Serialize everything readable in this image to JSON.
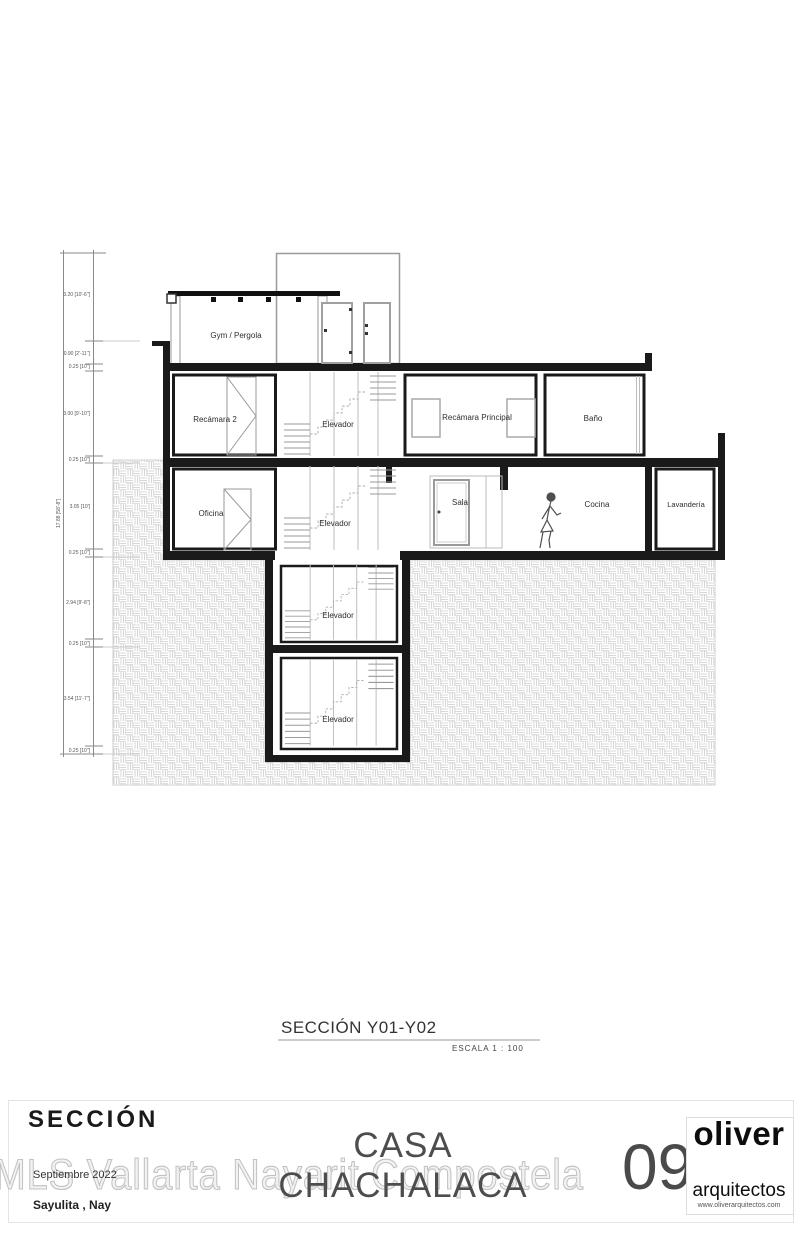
{
  "sheet": {
    "section_label": "SECCIÓN Y01-Y02",
    "scale_label": "ESCALA 1 : 100",
    "sheet_type": "SECCIÓN",
    "project_title": "CASA CHACHALACA",
    "watermark": "MLS Vallarta Nayarit Compostela",
    "date": "Septiembre 2022",
    "location": "Sayulita , Nay",
    "sheet_number": "09",
    "firm": {
      "name": "oliver",
      "subtitle": "arquitectos",
      "website": "www.oliverarquitectos.com"
    }
  },
  "rooms": {
    "gym_pergola": "Gym / Pergola",
    "recamara_2": "Recámara 2",
    "elevador_n1": "Elevador",
    "recamara_principal": "Recámara Principal",
    "bano": "Baño",
    "oficina": "Oficina",
    "elevador_n2": "Elevador",
    "sala": "Sala",
    "cocina": "Cocina",
    "lavanderia": "Lavandería",
    "elevador_b1": "Elevador",
    "elevador_b2": "Elevador"
  },
  "dimensions": {
    "total": "17.88 [58'-8\"]",
    "levels": [
      "3.20 [10'-6\"]",
      "0.90 [2'-11\"]",
      "0.25 [10\"]",
      "3.00 [9'-10\"]",
      "0.25 [10\"]",
      "3.05 [10']",
      "0.25 [10\"]",
      "2.94 [9'-8\"]",
      "0.25 [10\"]",
      "3.54 [11'-7\"]",
      "0.25 [10\"]"
    ]
  },
  "colors": {
    "wall_line": "#1a1a1a",
    "thin_line": "#9a9a9a",
    "hatch_line": "#cccccc",
    "watermark_text": "#e9e9e9"
  }
}
